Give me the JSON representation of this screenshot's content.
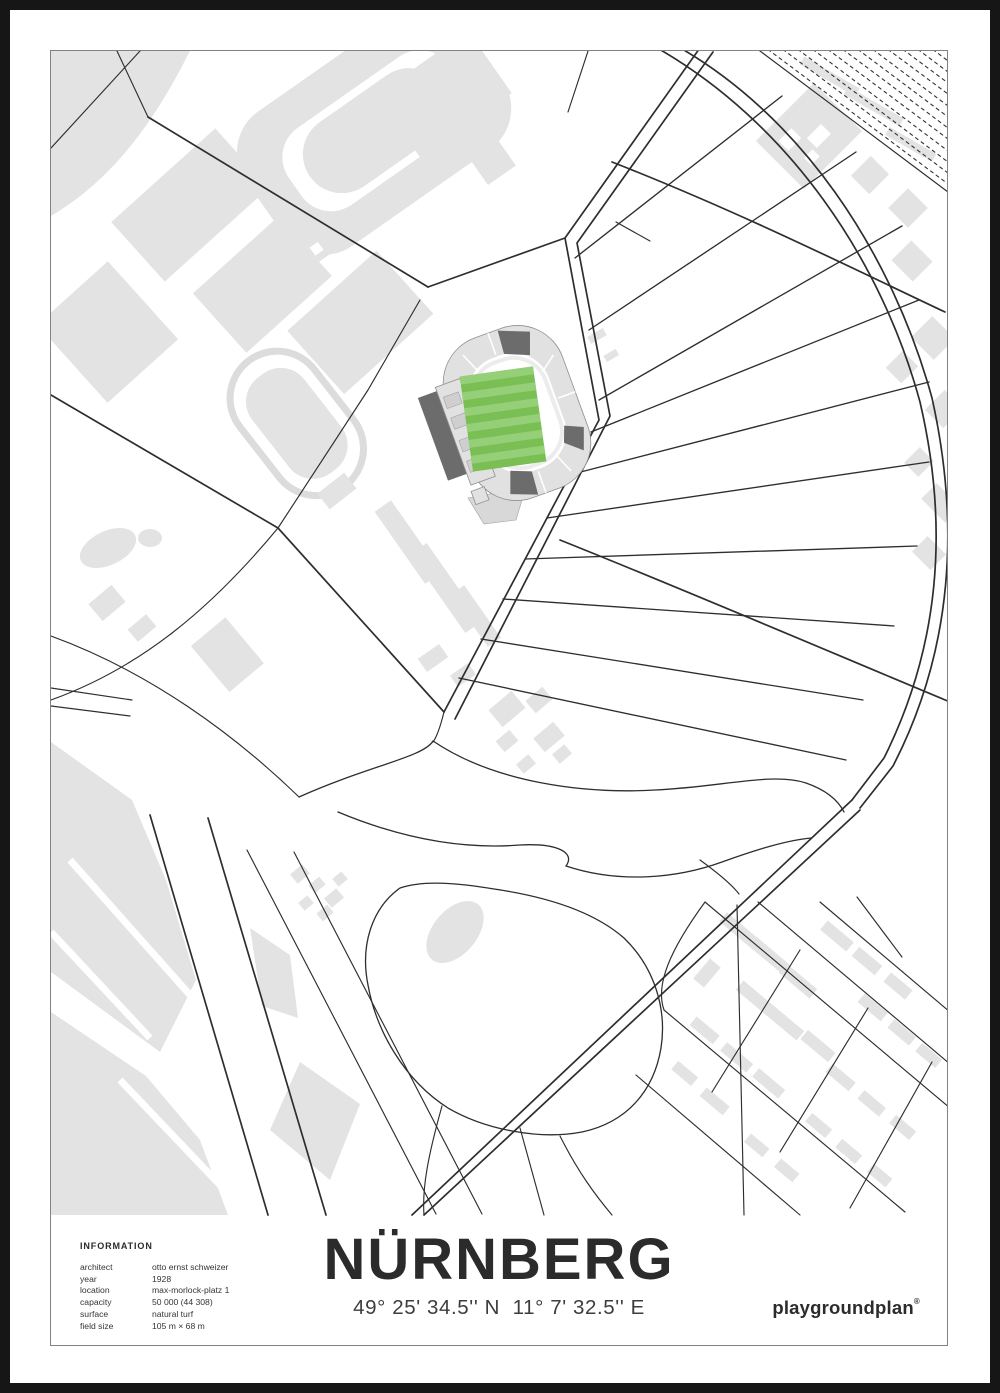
{
  "poster": {
    "title": "NÜRNBERG",
    "coordinates": "49° 25' 34.5'' N  11° 7' 32.5'' E",
    "brand": "playgroundplan",
    "brand_mark": "®",
    "info": {
      "heading": "INFORMATION",
      "rows": [
        {
          "label": "architect",
          "value": "otto ernst schweizer"
        },
        {
          "label": "year",
          "value": "1928"
        },
        {
          "label": "location",
          "value": "max-morlock-platz 1"
        },
        {
          "label": "capacity",
          "value": "50 000 (44 308)"
        },
        {
          "label": "surface",
          "value": "natural turf"
        },
        {
          "label": "field size",
          "value": "105 m × 68 m"
        }
      ]
    },
    "colors": {
      "poster_border": "#161616",
      "frame_line": "#828282",
      "building_gray": "#e3e3e3",
      "road_ink": "#2e2e2e",
      "stand_dark": "#6c6c6c",
      "pitch_green_dark": "#79bf53",
      "pitch_green_light": "#95cf78"
    }
  }
}
